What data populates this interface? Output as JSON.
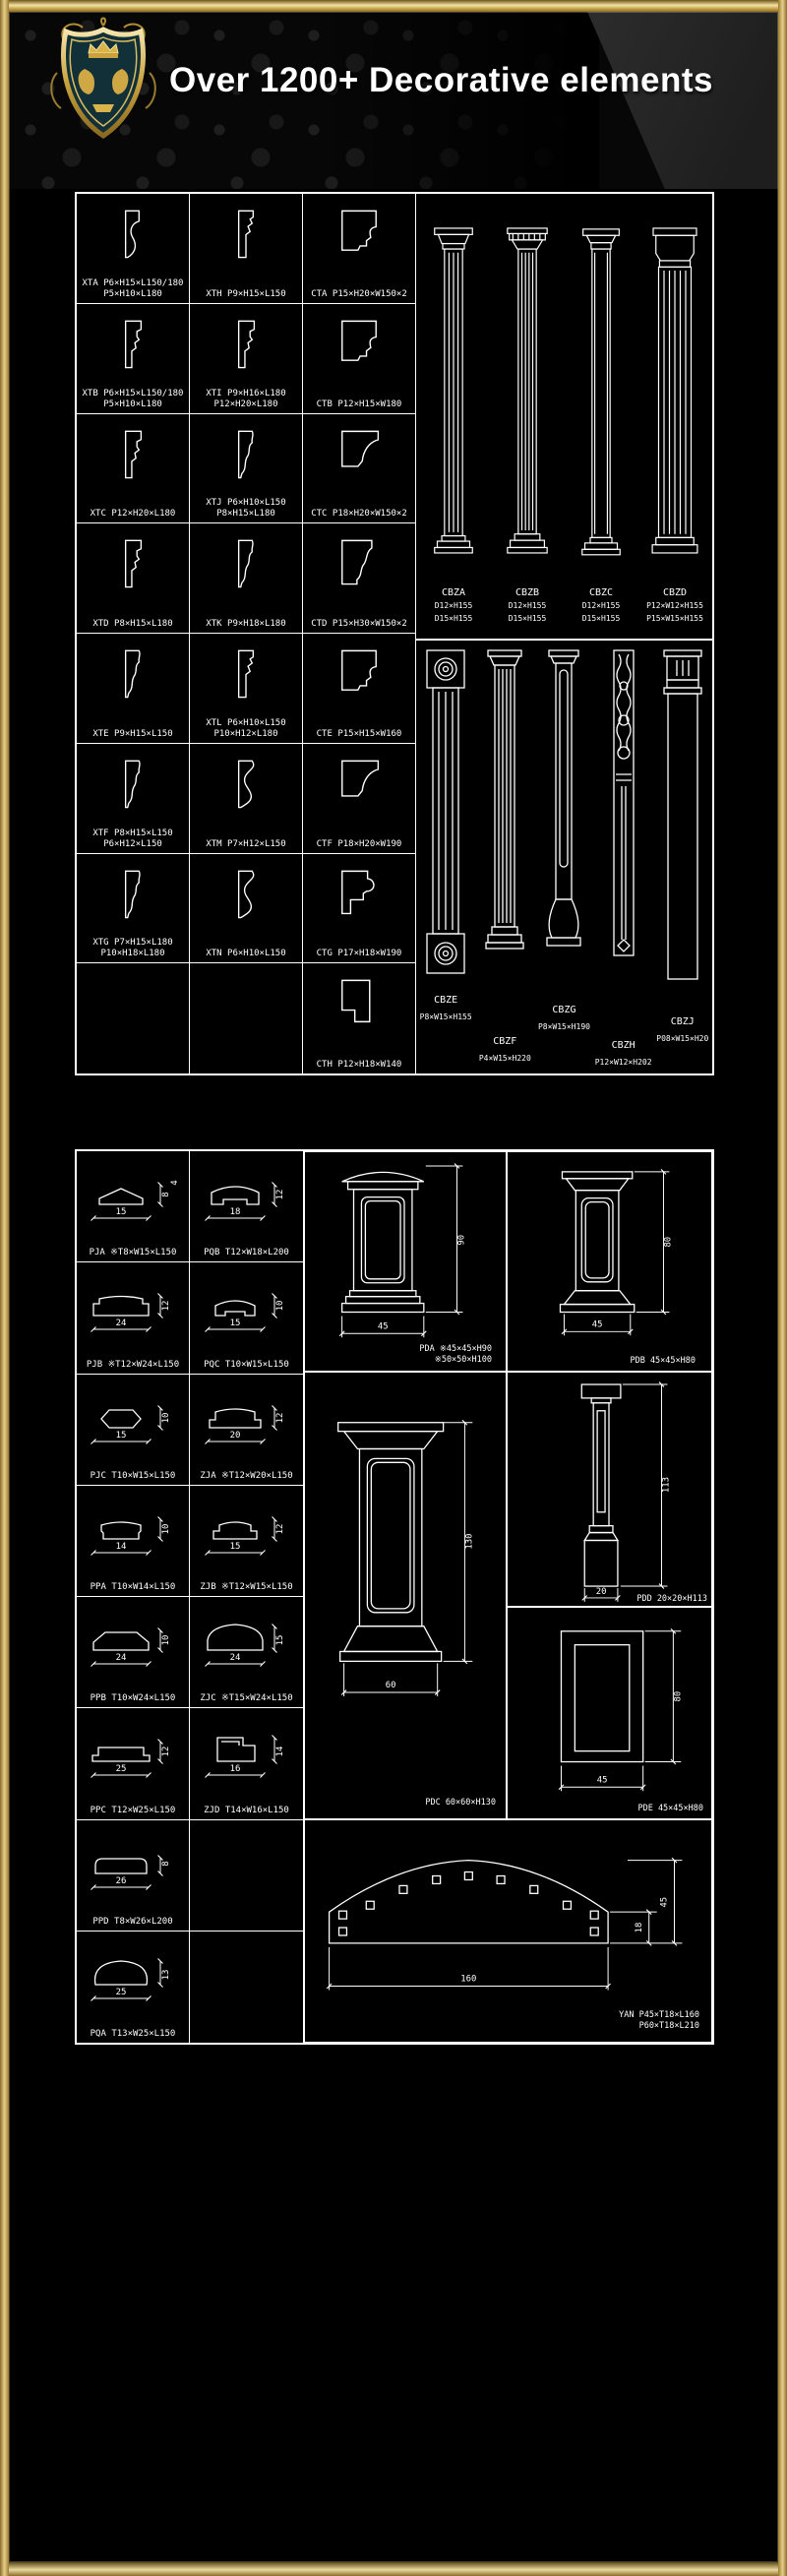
{
  "header": {
    "title": "Over 1200+ Decorative elements"
  },
  "panel1": {
    "moldings": [
      {
        "code": "XTA",
        "dims": "P6×H15×L150/180",
        "dims2": "P5×H10×L180"
      },
      {
        "code": "XTH",
        "dims": "P9×H15×L150",
        "dims2": ""
      },
      {
        "code": "CTA",
        "dims": "P15×H20×W150×2",
        "dims2": ""
      },
      {
        "code": "XTB",
        "dims": "P6×H15×L150/180",
        "dims2": "P5×H10×L180"
      },
      {
        "code": "XTI",
        "dims": "P9×H16×L180",
        "dims2": "P12×H20×L180"
      },
      {
        "code": "CTB",
        "dims": "P12×H15×W180",
        "dims2": ""
      },
      {
        "code": "XTC",
        "dims": "P12×H20×L180",
        "dims2": ""
      },
      {
        "code": "XTJ",
        "dims": "P6×H10×L150",
        "dims2": "P8×H15×L180"
      },
      {
        "code": "CTC",
        "dims": "P18×H20×W150×2",
        "dims2": ""
      },
      {
        "code": "XTD",
        "dims": "P8×H15×L180",
        "dims2": ""
      },
      {
        "code": "XTK",
        "dims": "P9×H18×L180",
        "dims2": ""
      },
      {
        "code": "CTD",
        "dims": "P15×H30×W150×2",
        "dims2": ""
      },
      {
        "code": "XTE",
        "dims": "P9×H15×L150",
        "dims2": ""
      },
      {
        "code": "XTL",
        "dims": "P6×H10×L150",
        "dims2": "P10×H12×L180"
      },
      {
        "code": "CTE",
        "dims": "P15×H15×W160",
        "dims2": ""
      },
      {
        "code": "XTF",
        "dims": "P8×H15×L150",
        "dims2": "P6×H12×L150"
      },
      {
        "code": "XTM",
        "dims": "P7×H12×L150",
        "dims2": ""
      },
      {
        "code": "CTF",
        "dims": "P18×H20×W190",
        "dims2": ""
      },
      {
        "code": "XTG",
        "dims": "P7×H15×L180",
        "dims2": "P10×H18×L180"
      },
      {
        "code": "XTN",
        "dims": "P6×H10×L150",
        "dims2": ""
      },
      {
        "code": "CTG",
        "dims": "P17×H18×W190",
        "dims2": ""
      },
      {
        "code": "CTH",
        "dims": "P12×H18×W140",
        "dims2": ""
      }
    ],
    "columns_top": [
      {
        "code": "CBZA",
        "dims": "D12×H155",
        "dims2": "D15×H155"
      },
      {
        "code": "CBZB",
        "dims": "D12×H155",
        "dims2": "D15×H155"
      },
      {
        "code": "CBZC",
        "dims": "D12×H155",
        "dims2": "D15×H155"
      },
      {
        "code": "CBZD",
        "dims": "P12×W12×H155",
        "dims2": "P15×W15×H155"
      }
    ],
    "columns_bottom": [
      {
        "code": "CBZE",
        "dims": "P8×W15×H155"
      },
      {
        "code": "CBZF",
        "dims": "P4×W15×H220"
      },
      {
        "code": "CBZG",
        "dims": "P8×W15×H190"
      },
      {
        "code": "CBZH",
        "dims": "P12×W12×H202"
      },
      {
        "code": "CBZJ",
        "dims": "P08×W15×H20"
      }
    ]
  },
  "panel2": {
    "profiles": [
      {
        "code": "PJA",
        "dims": "※T8×W15×L150",
        "w": "15",
        "h": "8",
        "h2": "4"
      },
      {
        "code": "PQB",
        "dims": "T12×W18×L200",
        "w": "18",
        "h": "12"
      },
      {
        "code": "PJB",
        "dims": "※T12×W24×L150",
        "w": "24",
        "h": "12"
      },
      {
        "code": "PQC",
        "dims": "T10×W15×L150",
        "w": "15",
        "h": "10"
      },
      {
        "code": "PJC",
        "dims": "T10×W15×L150",
        "w": "15",
        "h": "10"
      },
      {
        "code": "ZJA",
        "dims": "※T12×W20×L150",
        "w": "20",
        "h": "12"
      },
      {
        "code": "PPA",
        "dims": "T10×W14×L150",
        "w": "14",
        "h": "10"
      },
      {
        "code": "ZJB",
        "dims": "※T12×W15×L150",
        "w": "15",
        "h": "12"
      },
      {
        "code": "PPB",
        "dims": "T10×W24×L150",
        "w": "24",
        "h": "10"
      },
      {
        "code": "ZJC",
        "dims": "※T15×W24×L150",
        "w": "24",
        "h": "15"
      },
      {
        "code": "PPC",
        "dims": "T12×W25×L150",
        "w": "25",
        "h": "12"
      },
      {
        "code": "ZJD",
        "dims": "T14×W16×L150",
        "w": "16",
        "h": "14"
      },
      {
        "code": "PPD",
        "dims": "T8×W26×L200",
        "w": "26",
        "h": "8"
      },
      {
        "code": "PQA",
        "dims": "T13×W25×L150",
        "w": "25",
        "h": "13"
      }
    ],
    "pedestals": [
      {
        "label": "PDA ※45×45×H90",
        "label2": "※50×50×H100",
        "w": "45",
        "h": "90"
      },
      {
        "label": "PDB 45×45×H80",
        "label2": "",
        "w": "45",
        "h": "80"
      },
      {
        "label": "PDC 60×60×H130",
        "label2": "",
        "w": "60",
        "h": "130"
      },
      {
        "label": "PDD 20×20×H113",
        "label2": "",
        "w": "20",
        "h": "113"
      },
      {
        "label": "PDE 45×45×H80",
        "label2": "",
        "w": "45",
        "h": "80"
      }
    ],
    "arch": {
      "label": "YAN P45×T18×L160",
      "label2": "P60×T18×L210",
      "w": "160",
      "h1": "18",
      "h2": "45"
    }
  }
}
